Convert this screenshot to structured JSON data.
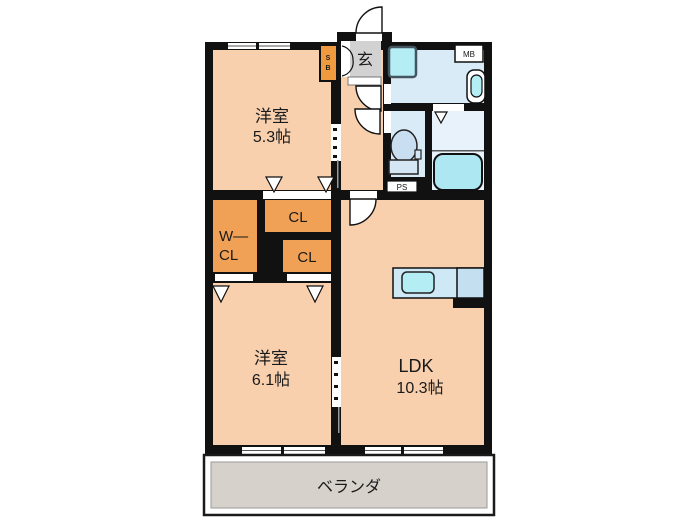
{
  "plan": {
    "rooms": {
      "bedroom1": {
        "label": "洋室",
        "size": "5.3帖"
      },
      "bedroom2": {
        "label": "洋室",
        "size": "6.1帖"
      },
      "ldk": {
        "label": "LDK",
        "size": "10.3帖"
      },
      "closet_top": {
        "label": "CL"
      },
      "closet_bottom": {
        "label": "CL"
      },
      "walkin_closet": {
        "line1": "W—",
        "line2": "CL"
      },
      "entrance": {
        "label": "玄"
      },
      "veranda": {
        "label": "ベランダ"
      }
    },
    "service_boxes": {
      "shoe_box_line1": "S",
      "shoe_box_line2": "B",
      "meter_box": "MB",
      "pipe_space": "PS"
    },
    "colors": {
      "wall": "#111111",
      "room_peach": "#f8d0ae",
      "closet_orange": "#f0a155",
      "shoe_box_orange": "#f09a40",
      "wet_area_blue": "#d9ebf7",
      "bath_floor_blue": "#e8f2fa",
      "fixture_cyan": "#b5edf4",
      "counter_blue": "#cfe8f6",
      "counter_blue_dark": "#c3dff0",
      "toilet_blue": "#c9def1",
      "entrance_gray": "#d2d2d2",
      "veranda_gray": "#d6d1cb",
      "background": "#ffffff"
    }
  }
}
